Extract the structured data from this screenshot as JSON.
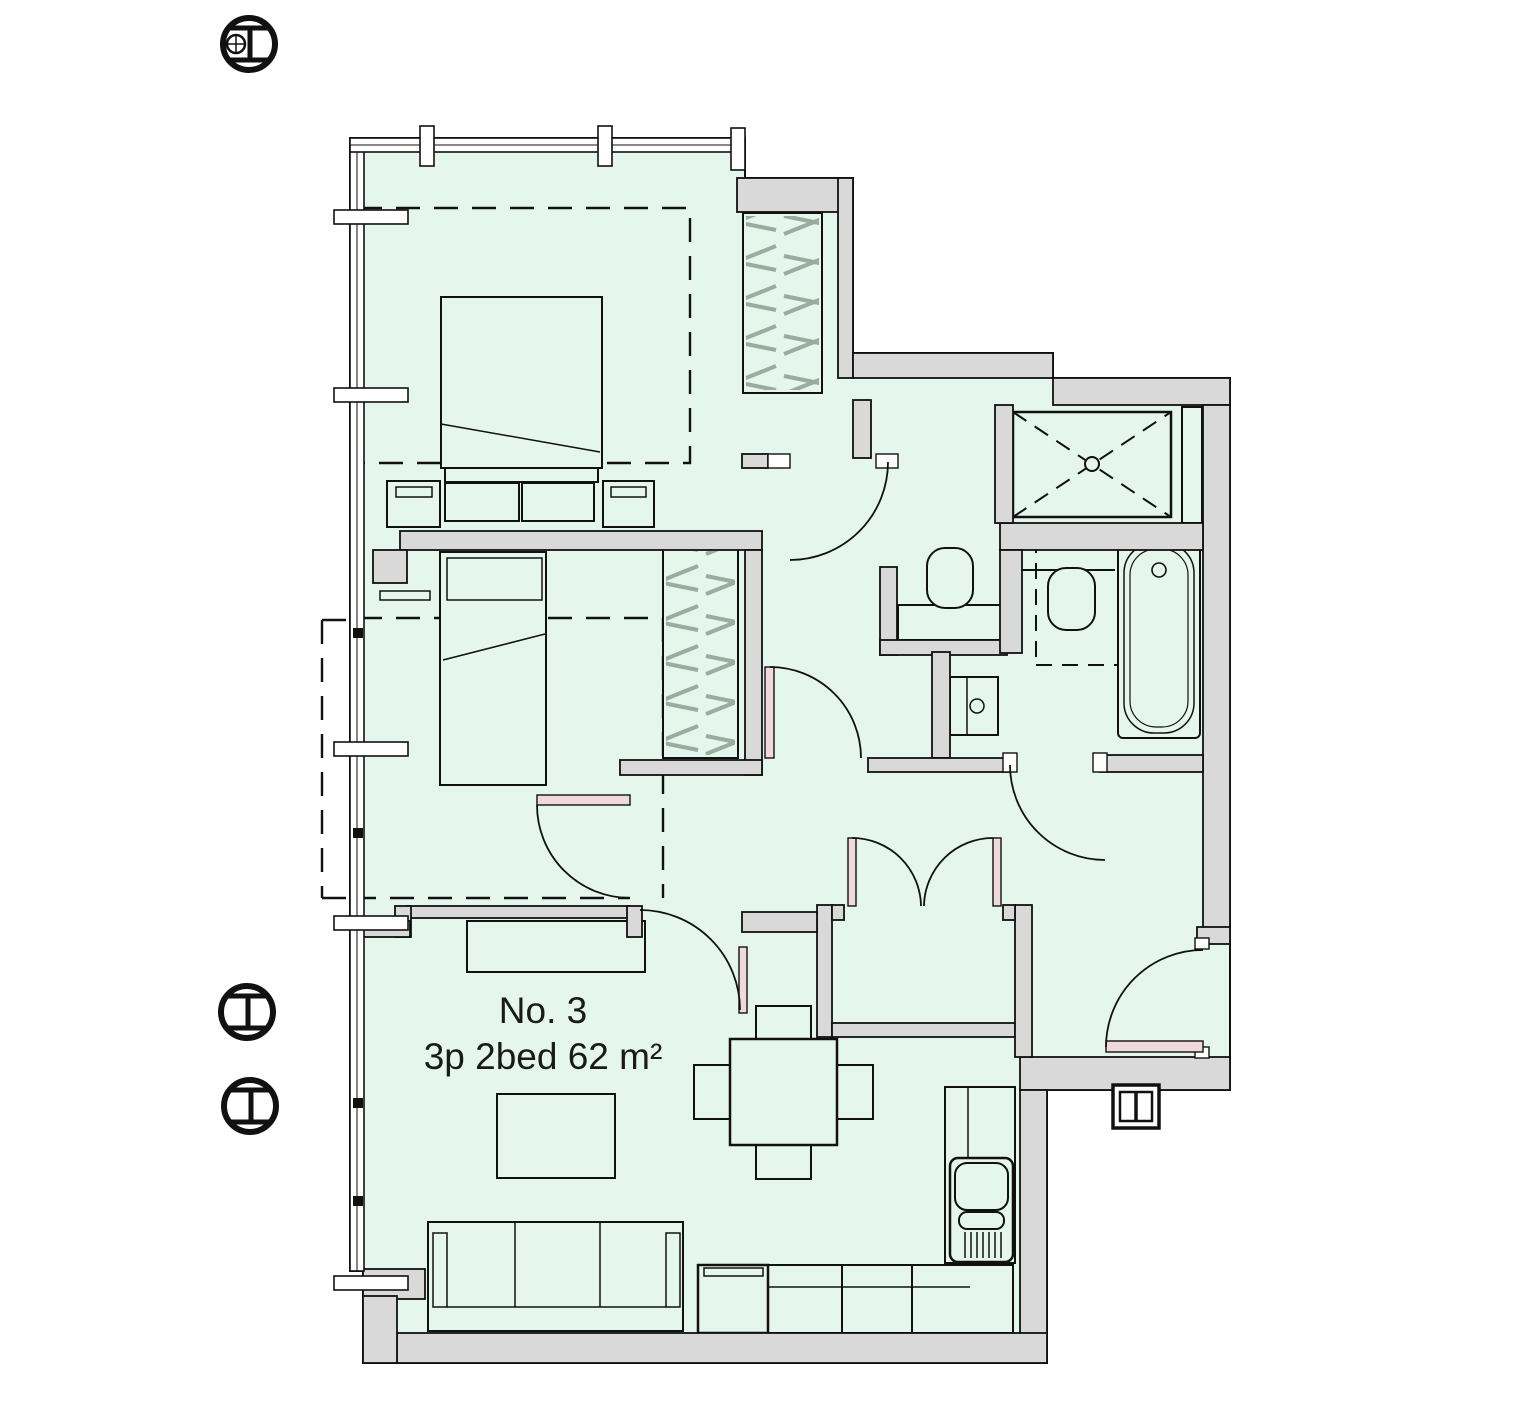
{
  "labels": {
    "unit_number": "No. 3",
    "unit_spec": "3p 2bed 62 m²"
  },
  "colors": {
    "floor": "#e5f6ec",
    "wall": "#d9d9d9",
    "outline": "#111111",
    "hatch": "#9aab9f",
    "door_leaf": "#f0d9de",
    "window": "#ffffff",
    "background": "#ffffff",
    "text": "#1a1a1a"
  },
  "symbols": {
    "section_markers": [
      {
        "name": "column-section-marker-with-survey-point"
      },
      {
        "name": "column-section-marker"
      },
      {
        "name": "column-section-marker"
      }
    ],
    "meter_box": {
      "name": "meter-box"
    }
  }
}
